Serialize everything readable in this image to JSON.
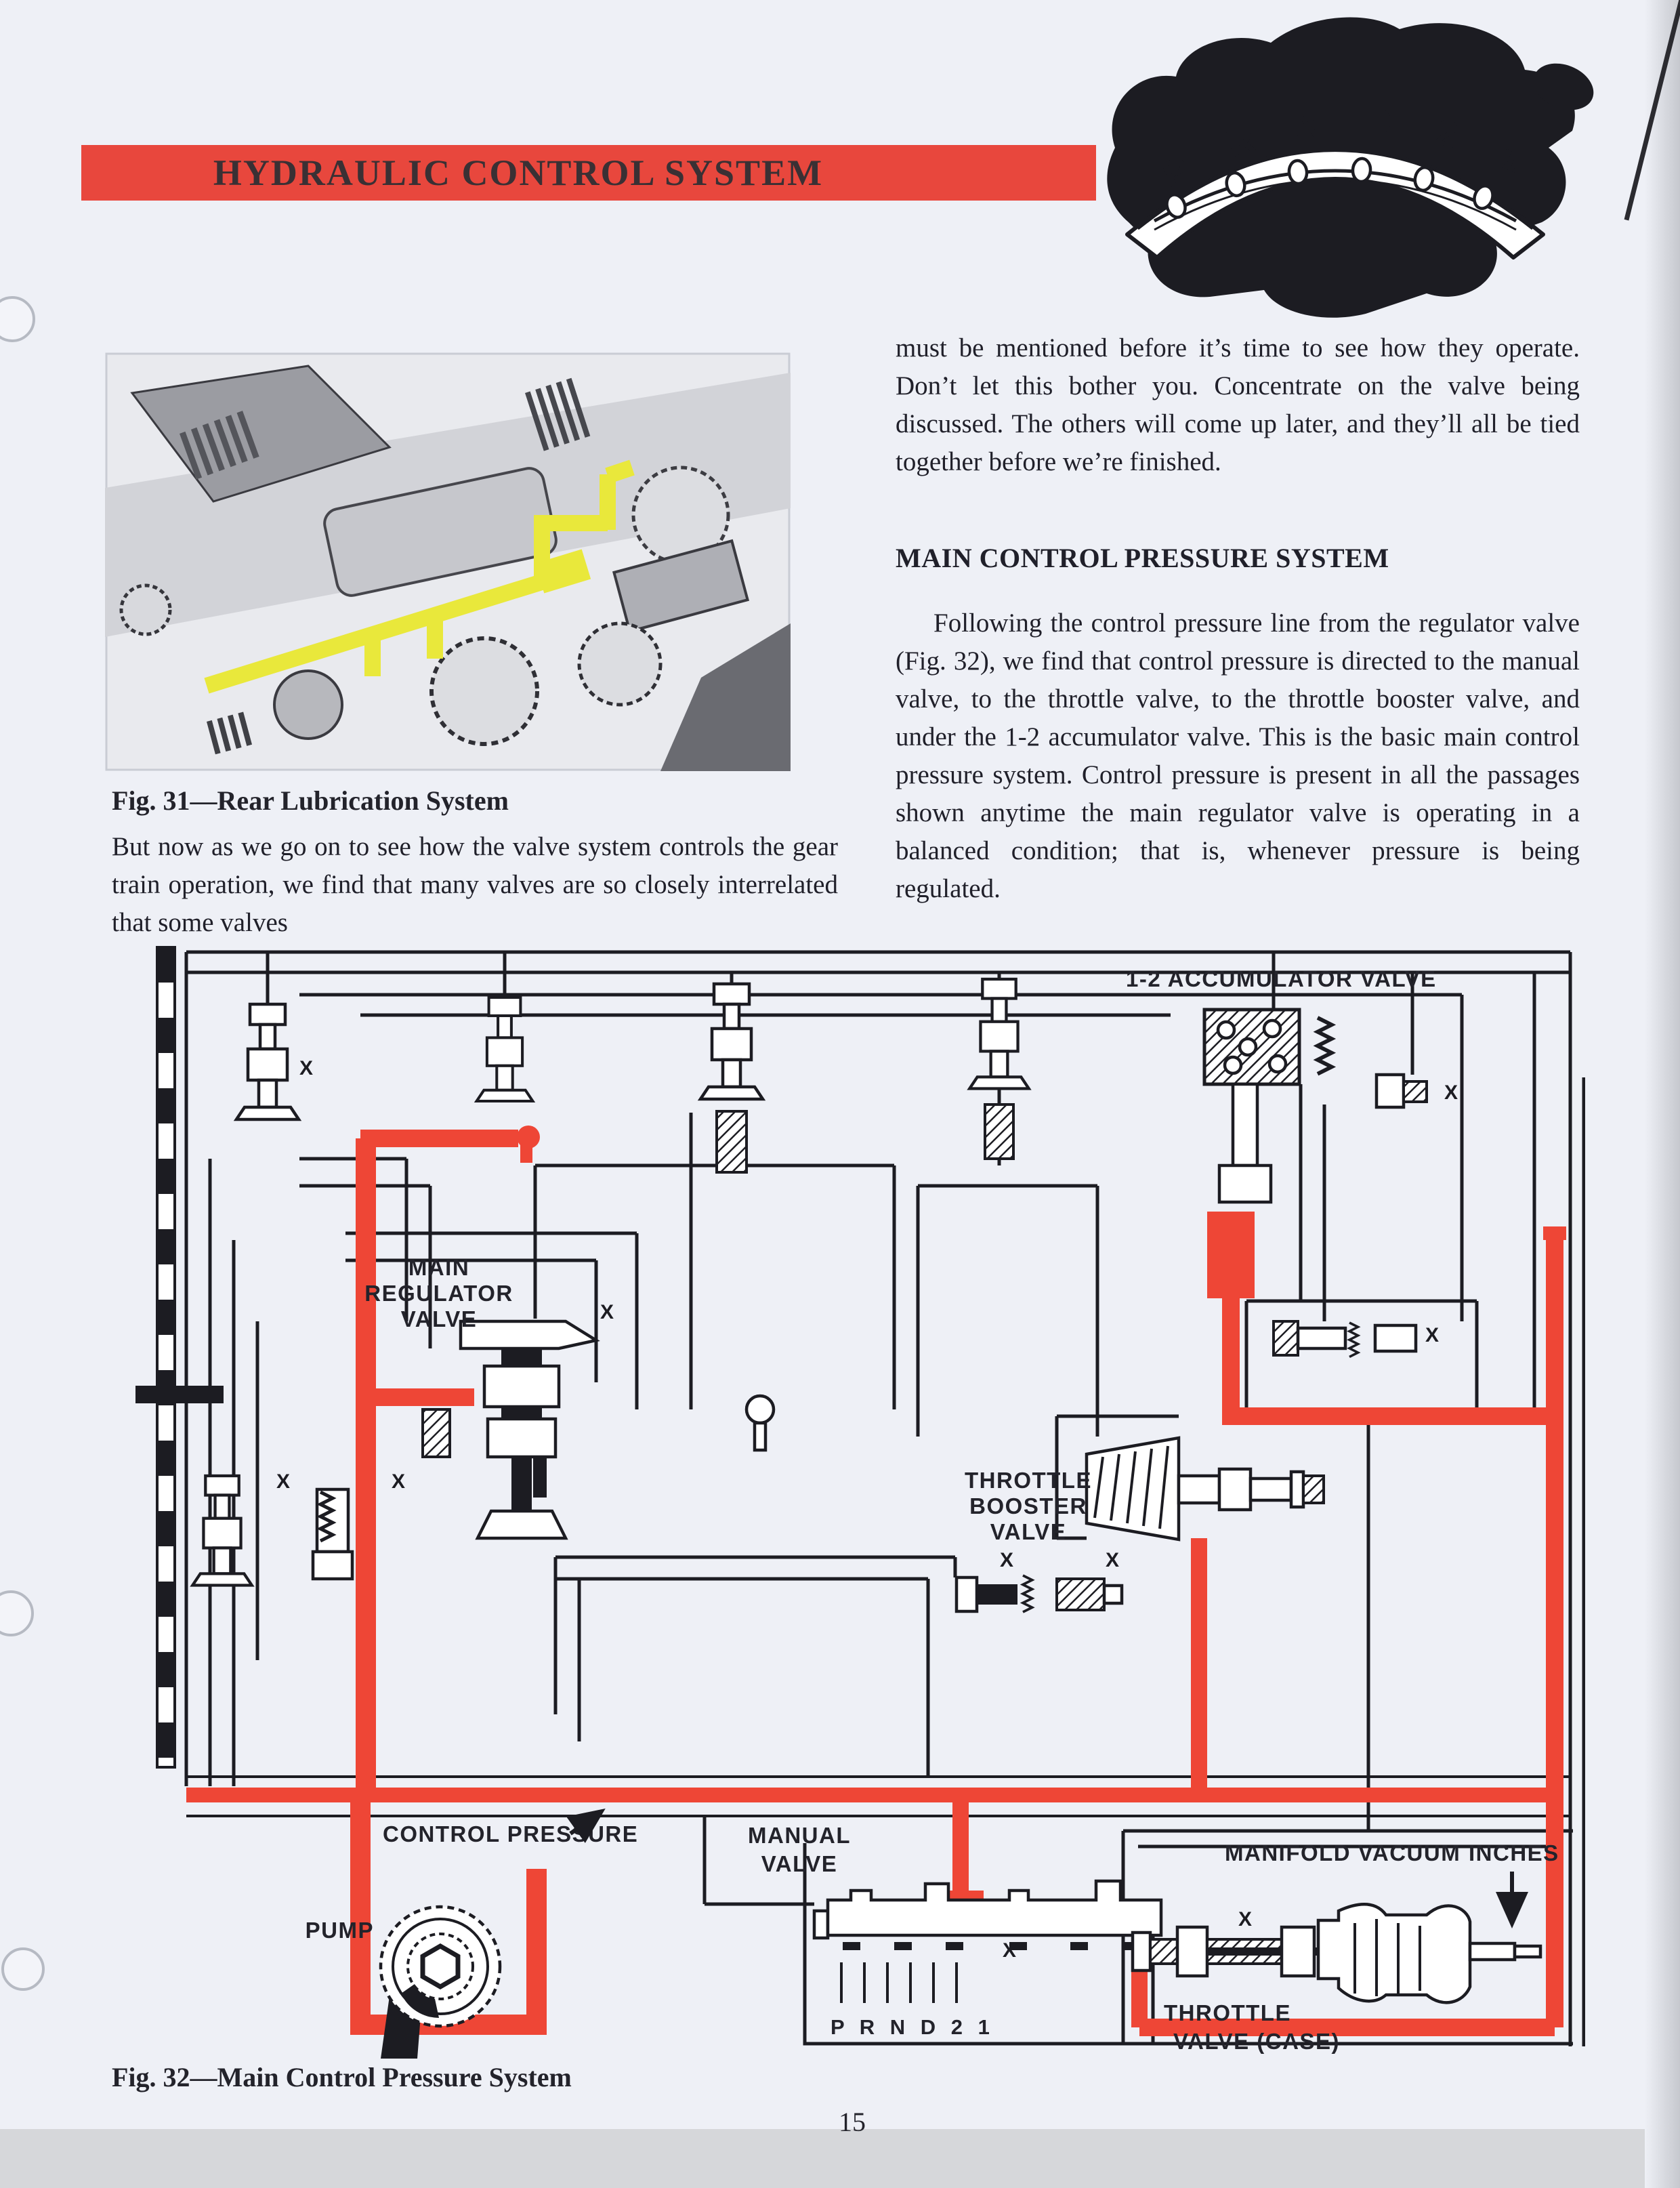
{
  "page": {
    "number": "15",
    "title_bar": "HYDRAULIC CONTROL SYSTEM"
  },
  "badge": {
    "letters": [
      "P",
      "R",
      "N",
      "D",
      "2",
      "1"
    ]
  },
  "fig31": {
    "caption": "Fig. 31—Rear Lubrication System"
  },
  "text": {
    "left_para": "But now as we go on to see how the valve system controls the gear train operation, we find that many valves are so closely interrelated that some valves",
    "right_para1": "must be mentioned before it’s time to see how they operate. Don’t let this bother you. Concentrate on the valve being discussed. The others will come up later, and they’ll all be tied together before we’re finished.",
    "section_heading": "MAIN CONTROL PRESSURE SYSTEM",
    "right_para2": "Following the control pressure line from the regulator valve (Fig. 32), we find that control pressure is directed to the manual valve, to the throttle valve, to the throttle booster valve, and under the 1-2 accumulator valve. This is the basic main control pressure system. Control pressure is present in all the passages shown anytime the main regulator valve is operating in a balanced condition; that is, whenever pressure is being regulated."
  },
  "fig32": {
    "caption": "Fig. 32—Main Control Pressure System",
    "labels": {
      "accumulator": "1-2 ACCUMULATOR VALVE",
      "main_regulator_1": "MAIN",
      "main_regulator_2": "REGULATOR",
      "main_regulator_3": "VALVE",
      "throttle_booster_1": "THROTTLE",
      "throttle_booster_2": "BOOSTER",
      "throttle_booster_3": "VALVE",
      "control_pressure": "CONTROL PRESSURE",
      "pump": "PUMP",
      "manual_valve_1": "MANUAL",
      "manual_valve_2": "VALVE",
      "shift_positions": "P R N D 2 1",
      "manifold_vacuum": "MANIFOLD VACUUM",
      "inches": "INCHES",
      "throttle_valve_1": "THROTTLE",
      "throttle_valve_2": "VALVE (CASE)",
      "x_mark": "X"
    },
    "colors": {
      "pressure_red": "#ee4636",
      "header_red": "#e8473d",
      "lubrication_yellow": "#e9e83b",
      "ink_black": "#1c1c22"
    }
  }
}
